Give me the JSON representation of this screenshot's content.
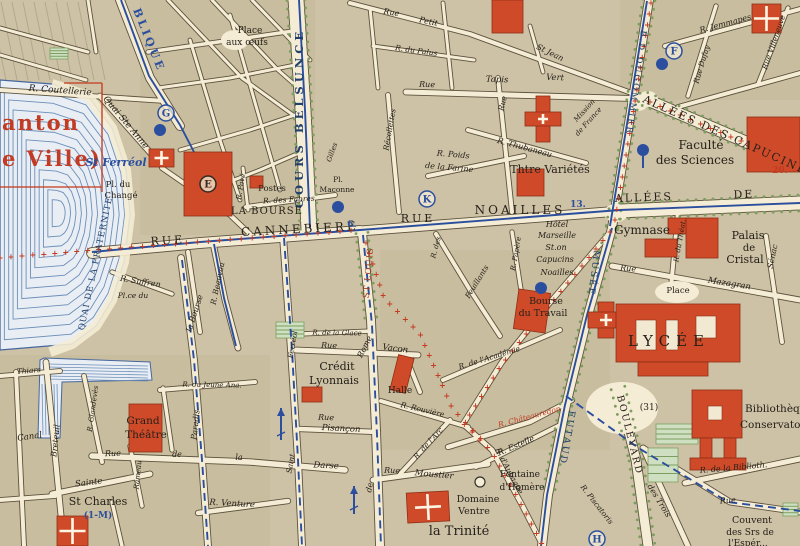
{
  "map": {
    "palette": {
      "paper": "#cdc2a6",
      "block_dark": "#c3b795",
      "street": "#f4ecd4",
      "casing": "#564c38",
      "water_fill": "#e9eef5",
      "water_line": "#6c8fb8",
      "water_edge": "#47679c",
      "building_red": "#cf4a28",
      "building_edge": "#8e2f16",
      "route_red": "#c23b22",
      "route_blue": "#2b4f9e",
      "tree_green": "#7c9e5e",
      "park_fill": "#cfe0c2",
      "text_black": "#26201a",
      "text_blue": "#2b4f9e",
      "text_navy": "#21406b",
      "text_red": "#c23b22",
      "text_redbrown": "#a23c22"
    },
    "labels": [
      {
        "t": "anton",
        "x": 2,
        "y": 130,
        "s": 21,
        "c": "r",
        "v": "b",
        "a": "s",
        "ls": 2
      },
      {
        "t": "e Ville)",
        "x": 2,
        "y": 166,
        "s": 21,
        "c": "r",
        "v": "b",
        "a": "s",
        "ls": 2
      },
      {
        "t": "BLIQUE",
        "x": 133,
        "y": 10,
        "r": 68,
        "s": 11,
        "c": "b",
        "v": "b",
        "ls": 3,
        "a": "s"
      },
      {
        "t": "R. Coutellerie",
        "x": 60,
        "y": 93,
        "r": 4,
        "s": 9,
        "c": "k",
        "v": "it"
      },
      {
        "t": "Quai Ste Anne",
        "x": 124,
        "y": 124,
        "r": 50,
        "s": 9,
        "c": "k",
        "v": "it"
      },
      {
        "t": "St Ferréol",
        "x": 116,
        "y": 166,
        "s": 11,
        "c": "b",
        "v": "bi"
      },
      {
        "t": "Place",
        "x": 250,
        "y": 33,
        "s": 9,
        "c": "k"
      },
      {
        "t": "aux œufs",
        "x": 247,
        "y": 45,
        "s": 9,
        "c": "k"
      },
      {
        "t": "Rue",
        "x": 391,
        "y": 15,
        "r": 10,
        "s": 8,
        "c": "k",
        "v": "it"
      },
      {
        "t": "Petit",
        "x": 428,
        "y": 24,
        "r": 12,
        "s": 8,
        "c": "k",
        "v": "it"
      },
      {
        "t": "St Jean",
        "x": 549,
        "y": 55,
        "r": 26,
        "s": 8,
        "c": "k",
        "v": "it"
      },
      {
        "t": "R. du Palus",
        "x": 416,
        "y": 53,
        "r": 8,
        "s": 7.5,
        "c": "k",
        "v": "it"
      },
      {
        "t": "Rue",
        "x": 427,
        "y": 87,
        "r": 2,
        "s": 8,
        "c": "k",
        "v": "it"
      },
      {
        "t": "Tapis",
        "x": 497,
        "y": 82,
        "r": 2,
        "s": 8.5,
        "c": "k",
        "v": "it"
      },
      {
        "t": "Vert",
        "x": 555,
        "y": 80,
        "r": 2,
        "s": 8.5,
        "c": "k",
        "v": "it"
      },
      {
        "t": "R. Thubaneau",
        "x": 524,
        "y": 150,
        "r": 15,
        "s": 8,
        "c": "k",
        "v": "it"
      },
      {
        "t": "Récollettes",
        "x": 392,
        "y": 130,
        "r": -80,
        "s": 7.5,
        "c": "k",
        "v": "it"
      },
      {
        "t": "Rue",
        "x": 505,
        "y": 104,
        "r": -76,
        "s": 7.5,
        "c": "k",
        "v": "it"
      },
      {
        "t": "R. Poids",
        "x": 453,
        "y": 157,
        "r": 5,
        "s": 8,
        "c": "k",
        "v": "it"
      },
      {
        "t": "de la Farine",
        "x": 449,
        "y": 170,
        "r": 5,
        "s": 8,
        "c": "k",
        "v": "it"
      },
      {
        "t": "COURS BELSUNCE",
        "x": 303,
        "y": 118,
        "r": -90,
        "s": 11.5,
        "c": "n",
        "v": "b",
        "ls": 4
      },
      {
        "t": "RUE",
        "x": 168,
        "y": 244,
        "r": -3,
        "s": 11,
        "c": "k",
        "ls": 3
      },
      {
        "t": "CANNEBIERE",
        "x": 300,
        "y": 233,
        "r": -3,
        "s": 12,
        "c": "k",
        "ls": 3
      },
      {
        "t": "LA BOURSE",
        "x": 267,
        "y": 214,
        "s": 10,
        "c": "k",
        "ls": 1
      },
      {
        "t": "Postes",
        "x": 272,
        "y": 191,
        "s": 8.5,
        "c": "k"
      },
      {
        "t": "R. des Fabres",
        "x": 289,
        "y": 202,
        "r": -3,
        "s": 7.5,
        "c": "k",
        "v": "it"
      },
      {
        "t": "Pl.",
        "x": 338,
        "y": 182,
        "s": 7.5,
        "c": "k"
      },
      {
        "t": "Maconne",
        "x": 337,
        "y": 192,
        "s": 7.5,
        "c": "k"
      },
      {
        "t": "Pl. du",
        "x": 118,
        "y": 187,
        "s": 8.5,
        "c": "k"
      },
      {
        "t": "Changé",
        "x": 121,
        "y": 198,
        "s": 8.5,
        "c": "k"
      },
      {
        "t": "QUAI DE LA FRATERNITE",
        "x": 98,
        "y": 264,
        "r": -78,
        "s": 8.5,
        "c": "n",
        "ls": 1
      },
      {
        "t": "R. Suffren",
        "x": 140,
        "y": 284,
        "r": 9,
        "s": 8,
        "c": "k",
        "v": "it"
      },
      {
        "t": "Pl.ce du",
        "x": 133,
        "y": 298,
        "s": 7.5,
        "c": "k",
        "v": "it"
      },
      {
        "t": "la Bourse",
        "x": 197,
        "y": 314,
        "r": -72,
        "s": 8,
        "c": "k",
        "v": "it"
      },
      {
        "t": "R. Beauvau",
        "x": 220,
        "y": 284,
        "r": -78,
        "s": 7.5,
        "c": "k",
        "v": "it"
      },
      {
        "t": "R. Pavé",
        "x": 243,
        "y": 187,
        "r": -80,
        "s": 7,
        "c": "k",
        "v": "it"
      },
      {
        "t": "6.",
        "x": 352,
        "y": 227,
        "s": 9,
        "c": "b",
        "v": "b"
      },
      {
        "t": "ST LOUIS",
        "x": 371,
        "y": 273,
        "r": -85,
        "s": 8.5,
        "c": "rb",
        "ls": 1
      },
      {
        "t": "RUE",
        "x": 418,
        "y": 222,
        "s": 11,
        "c": "k",
        "ls": 3
      },
      {
        "t": "NOAILLES",
        "x": 520,
        "y": 214,
        "s": 12,
        "c": "k",
        "ls": 3
      },
      {
        "t": "13.",
        "x": 578,
        "y": 207,
        "s": 9,
        "c": "b",
        "v": "b"
      },
      {
        "t": "Thtre Variétés",
        "x": 550,
        "y": 173,
        "s": 11,
        "c": "k"
      },
      {
        "t": "Hôtel",
        "x": 557,
        "y": 227,
        "s": 8,
        "c": "k",
        "v": "it"
      },
      {
        "t": "Marseille",
        "x": 557,
        "y": 238,
        "s": 8,
        "c": "k",
        "v": "it"
      },
      {
        "t": "St.on",
        "x": 556,
        "y": 250,
        "s": 8,
        "c": "k",
        "v": "it"
      },
      {
        "t": "Capucins",
        "x": 555,
        "y": 262,
        "s": 8,
        "c": "k",
        "v": "it"
      },
      {
        "t": "Noailles",
        "x": 557,
        "y": 275,
        "s": 8,
        "c": "k",
        "v": "it"
      },
      {
        "t": "R. des",
        "x": 438,
        "y": 248,
        "r": -75,
        "s": 7,
        "c": "k",
        "v": "it"
      },
      {
        "t": "Feuillants",
        "x": 479,
        "y": 283,
        "r": -58,
        "s": 7.5,
        "c": "k",
        "v": "it"
      },
      {
        "t": "R. Papère",
        "x": 518,
        "y": 254,
        "r": -80,
        "s": 7,
        "c": "k",
        "v": "it"
      },
      {
        "t": "MUSÉE",
        "x": 594,
        "y": 250,
        "r": 97,
        "s": 9,
        "c": "n",
        "ls": 2,
        "a": "s"
      },
      {
        "t": "Bourse",
        "x": 546,
        "y": 304,
        "s": 9.5,
        "c": "k"
      },
      {
        "t": "du Travail",
        "x": 543,
        "y": 316,
        "s": 9.5,
        "c": "k"
      },
      {
        "t": "Gymnase",
        "x": 642,
        "y": 234,
        "s": 12,
        "c": "k"
      },
      {
        "t": "Palais",
        "x": 748,
        "y": 239,
        "s": 11,
        "c": "k"
      },
      {
        "t": "de",
        "x": 749,
        "y": 251,
        "s": 10,
        "c": "k"
      },
      {
        "t": "Cristal",
        "x": 745,
        "y": 263,
        "s": 11,
        "c": "k"
      },
      {
        "t": "Rue",
        "x": 628,
        "y": 271,
        "r": 4,
        "s": 8,
        "c": "k",
        "v": "it"
      },
      {
        "t": "Mazagran",
        "x": 729,
        "y": 286,
        "r": 9,
        "s": 8.5,
        "c": "k",
        "v": "it"
      },
      {
        "t": "R. du Théat.",
        "x": 682,
        "y": 241,
        "r": -80,
        "s": 7,
        "c": "k",
        "v": "it"
      },
      {
        "t": "Sénac",
        "x": 775,
        "y": 257,
        "r": -78,
        "s": 8,
        "c": "k",
        "v": "it"
      },
      {
        "t": "Place",
        "x": 678,
        "y": 293,
        "s": 8.5,
        "c": "k"
      },
      {
        "t": "LYCÉE",
        "x": 669,
        "y": 346,
        "s": 15,
        "c": "k",
        "ls": 6
      },
      {
        "t": "ALLÉES",
        "x": 644,
        "y": 201,
        "r": -2,
        "s": 11,
        "c": "k",
        "ls": 2
      },
      {
        "t": "DE",
        "x": 744,
        "y": 198,
        "r": -2,
        "s": 11,
        "c": "k",
        "ls": 2
      },
      {
        "t": "ALLÉES DES CAPUCINES",
        "x": 728,
        "y": 140,
        "r": 24,
        "s": 11,
        "c": "k",
        "ls": 2
      },
      {
        "t": "B.D DUGOMMIER",
        "x": 641,
        "y": 30,
        "r": 98,
        "s": 8.5,
        "c": "n",
        "ls": 2,
        "a": "s"
      },
      {
        "t": "R. Jemmapes",
        "x": 726,
        "y": 26,
        "r": -15,
        "s": 8,
        "c": "k",
        "v": "it"
      },
      {
        "t": "Rue Dufay",
        "x": 704,
        "y": 65,
        "r": -73,
        "s": 7.5,
        "c": "k",
        "v": "it"
      },
      {
        "t": "Rue Villeneuve",
        "x": 776,
        "y": 43,
        "r": -71,
        "s": 7.5,
        "c": "k",
        "v": "it"
      },
      {
        "t": "Mission",
        "x": 586,
        "y": 112,
        "r": -48,
        "s": 7,
        "c": "k",
        "v": "it"
      },
      {
        "t": "de France",
        "x": 590,
        "y": 123,
        "r": -48,
        "s": 7,
        "c": "k",
        "v": "it"
      },
      {
        "t": "Faculté",
        "x": 701,
        "y": 149,
        "s": 12,
        "c": "k"
      },
      {
        "t": "des Sciences",
        "x": 695,
        "y": 164,
        "s": 12,
        "c": "k"
      },
      {
        "t": "20.",
        "x": 780,
        "y": 173,
        "s": 9,
        "c": "r",
        "v": "b"
      },
      {
        "t": "Crédit",
        "x": 337,
        "y": 370,
        "s": 11,
        "c": "k"
      },
      {
        "t": "Lyonnais",
        "x": 334,
        "y": 384,
        "s": 11,
        "c": "k"
      },
      {
        "t": "Rue",
        "x": 329,
        "y": 348,
        "r": 2,
        "s": 8,
        "c": "k",
        "v": "it"
      },
      {
        "t": "Vacon",
        "x": 395,
        "y": 351,
        "r": 7,
        "s": 8.5,
        "c": "k",
        "v": "it"
      },
      {
        "t": "R. de la Glace",
        "x": 337,
        "y": 335,
        "r": 1,
        "s": 7,
        "c": "k",
        "v": "it"
      },
      {
        "t": "Rue",
        "x": 326,
        "y": 420,
        "r": 2,
        "s": 8,
        "c": "k",
        "v": "it"
      },
      {
        "t": "Pisançon",
        "x": 341,
        "y": 431,
        "r": 3,
        "s": 8.5,
        "c": "k",
        "v": "it"
      },
      {
        "t": "Rome",
        "x": 367,
        "y": 348,
        "r": -63,
        "s": 8,
        "c": "k",
        "v": "it"
      },
      {
        "t": "de",
        "x": 372,
        "y": 488,
        "r": -78,
        "s": 8,
        "c": "k",
        "v": "it"
      },
      {
        "t": "Ferréol",
        "x": 295,
        "y": 345,
        "r": -80,
        "s": 7.5,
        "c": "k",
        "v": "it"
      },
      {
        "t": "Saint",
        "x": 293,
        "y": 464,
        "r": -80,
        "s": 7.5,
        "c": "k",
        "v": "it"
      },
      {
        "t": "Halle",
        "x": 400,
        "y": 393,
        "s": 9,
        "c": "k"
      },
      {
        "t": "R. Rouvière",
        "x": 422,
        "y": 412,
        "r": 13,
        "s": 7.5,
        "c": "k",
        "v": "it"
      },
      {
        "t": "R. de l'Arc",
        "x": 430,
        "y": 445,
        "r": -48,
        "s": 7.5,
        "c": "k",
        "v": "it"
      },
      {
        "t": "Rue",
        "x": 392,
        "y": 473,
        "r": 2,
        "s": 8,
        "c": "k",
        "v": "it"
      },
      {
        "t": "Moustier",
        "x": 434,
        "y": 477,
        "r": 5,
        "s": 8.5,
        "c": "k",
        "v": "it"
      },
      {
        "t": "Fontaine",
        "x": 520,
        "y": 477,
        "s": 9,
        "c": "k"
      },
      {
        "t": "d'Homère",
        "x": 522,
        "y": 490,
        "s": 9,
        "c": "k"
      },
      {
        "t": "Domaine",
        "x": 478,
        "y": 502,
        "s": 9.5,
        "c": "k"
      },
      {
        "t": "Ventre",
        "x": 474,
        "y": 514,
        "s": 9.5,
        "c": "k"
      },
      {
        "t": "la Trinité",
        "x": 459,
        "y": 535,
        "s": 13,
        "c": "k"
      },
      {
        "t": "R. d'Aubagne",
        "x": 507,
        "y": 472,
        "r": 62,
        "s": 7.5,
        "c": "k",
        "v": "it"
      },
      {
        "t": "R. Estelle",
        "x": 517,
        "y": 448,
        "r": -23,
        "s": 8,
        "c": "k",
        "v": "it"
      },
      {
        "t": "R. Châteauredon",
        "x": 530,
        "y": 419,
        "r": -15,
        "s": 7.5,
        "c": "r",
        "v": "it"
      },
      {
        "t": "R. de l'Académie",
        "x": 490,
        "y": 360,
        "r": -17,
        "s": 7.5,
        "c": "k",
        "v": "it"
      },
      {
        "t": "EUTAUD",
        "x": 569,
        "y": 410,
        "r": 100,
        "s": 9.5,
        "c": "n",
        "ls": 2,
        "a": "s"
      },
      {
        "t": "BOULEVARD",
        "x": 617,
        "y": 396,
        "r": 76,
        "s": 9.5,
        "c": "k",
        "ls": 2,
        "a": "s"
      },
      {
        "t": "R. Piscatoris",
        "x": 595,
        "y": 506,
        "r": 52,
        "s": 7.5,
        "c": "k",
        "v": "it"
      },
      {
        "t": "(31)",
        "x": 649,
        "y": 410,
        "s": 9,
        "c": "k"
      },
      {
        "t": "Bibliothèque",
        "x": 745,
        "y": 412,
        "s": 10.5,
        "c": "k",
        "a": "s"
      },
      {
        "t": "Conservatoire",
        "x": 740,
        "y": 428,
        "s": 10.5,
        "c": "k",
        "a": "s"
      },
      {
        "t": "R. de la Biblioth.",
        "x": 700,
        "y": 473,
        "r": -5,
        "s": 8,
        "c": "k",
        "v": "it",
        "a": "s"
      },
      {
        "t": "des Trois",
        "x": 657,
        "y": 502,
        "r": 58,
        "s": 8,
        "c": "k",
        "v": "it"
      },
      {
        "t": "Rue",
        "x": 728,
        "y": 503,
        "r": -4,
        "s": 8,
        "c": "k",
        "v": "it"
      },
      {
        "t": "Couvent",
        "x": 752,
        "y": 523,
        "s": 9.5,
        "c": "k"
      },
      {
        "t": "des Srs de",
        "x": 750,
        "y": 535,
        "s": 9,
        "c": "k"
      },
      {
        "t": "l'Espér...",
        "x": 748,
        "y": 546,
        "s": 9,
        "c": "k"
      },
      {
        "t": "Grand",
        "x": 143,
        "y": 424,
        "s": 10.5,
        "c": "k"
      },
      {
        "t": "Théâtre",
        "x": 146,
        "y": 438,
        "s": 10.5,
        "c": "k"
      },
      {
        "t": "Rue",
        "x": 113,
        "y": 456,
        "r": -2,
        "s": 8,
        "c": "k",
        "v": "it"
      },
      {
        "t": "de",
        "x": 177,
        "y": 457,
        "s": 8,
        "c": "k",
        "v": "it"
      },
      {
        "t": "la",
        "x": 239,
        "y": 460,
        "s": 8,
        "c": "k",
        "v": "it"
      },
      {
        "t": "Darse",
        "x": 326,
        "y": 468,
        "r": 3,
        "s": 8.5,
        "c": "k",
        "v": "it"
      },
      {
        "t": "Sainte",
        "x": 89,
        "y": 485,
        "r": -7,
        "s": 8.5,
        "c": "k",
        "v": "it"
      },
      {
        "t": "St Charles",
        "x": 98,
        "y": 505,
        "s": 11,
        "c": "k"
      },
      {
        "t": "(1-M)",
        "x": 98,
        "y": 518,
        "s": 9,
        "c": "b",
        "v": "b"
      },
      {
        "t": "R. Venture",
        "x": 232,
        "y": 506,
        "r": 3,
        "s": 8.5,
        "c": "k",
        "v": "it"
      },
      {
        "t": "Paradis",
        "x": 198,
        "y": 425,
        "r": -84,
        "s": 8,
        "c": "k",
        "v": "it"
      },
      {
        "t": "Breteuil",
        "x": 58,
        "y": 441,
        "r": -84,
        "s": 8,
        "c": "k",
        "v": "it"
      },
      {
        "t": "Canal",
        "x": 30,
        "y": 439,
        "r": -8,
        "s": 8.5,
        "c": "k",
        "v": "it"
      },
      {
        "t": "R. Glandevès",
        "x": 95,
        "y": 409,
        "r": -82,
        "s": 7,
        "c": "k",
        "v": "it"
      },
      {
        "t": "Rameau",
        "x": 140,
        "y": 475,
        "r": -84,
        "s": 7,
        "c": "k",
        "v": "it"
      },
      {
        "t": "Thiars",
        "x": 29,
        "y": 373,
        "r": -5,
        "s": 7.5,
        "c": "k",
        "v": "it"
      },
      {
        "t": "R. du Jeune Ana.",
        "x": 212,
        "y": 387,
        "r": 1,
        "s": 7,
        "c": "k",
        "v": "it"
      },
      {
        "t": "Gilles",
        "x": 334,
        "y": 153,
        "r": -70,
        "s": 7,
        "c": "k",
        "v": "it"
      }
    ],
    "circled_markers": [
      {
        "t": "G",
        "x": 166,
        "y": 113,
        "c": "b"
      },
      {
        "t": "E",
        "x": 208,
        "y": 184,
        "c": "k"
      },
      {
        "t": "K",
        "x": 427,
        "y": 199,
        "c": "b"
      },
      {
        "t": "F",
        "x": 674,
        "y": 51,
        "c": "b"
      },
      {
        "t": "H",
        "x": 597,
        "y": 539,
        "c": "b"
      }
    ]
  }
}
